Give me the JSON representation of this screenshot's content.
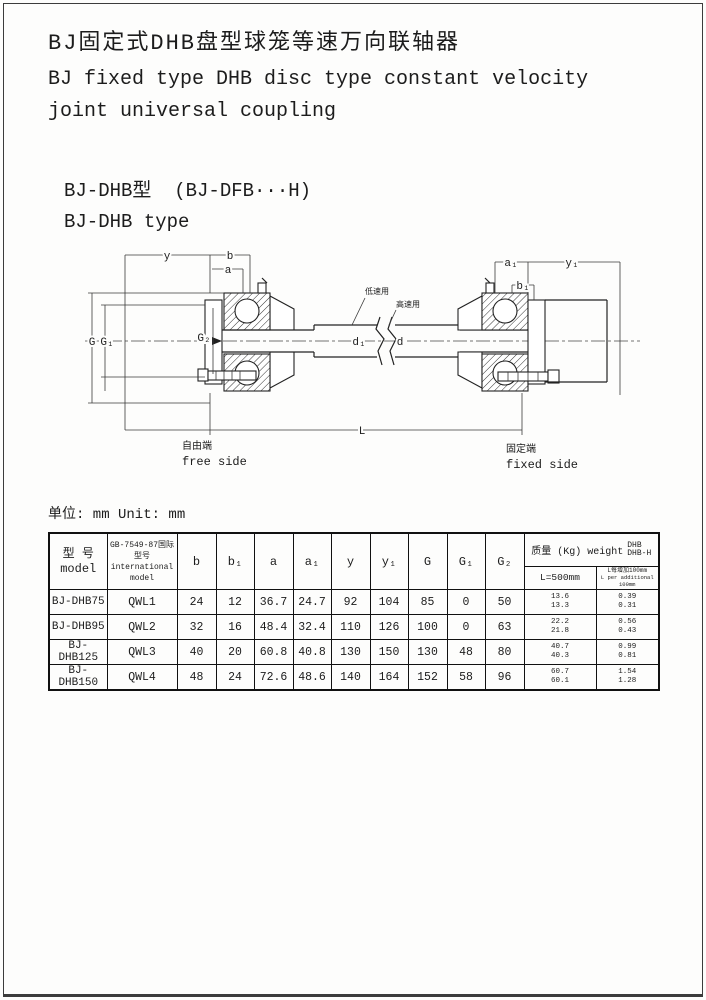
{
  "header": {
    "title_cn": "BJ固定式DHB盘型球笼等速万向联轴器",
    "title_en_line1": "BJ fixed type DHB disc type constant velocity",
    "title_en_line2": "joint universal coupling",
    "model_line_cn": "BJ-DHB型  (BJ-DFB···H)",
    "model_line_en": "BJ-DHB type"
  },
  "diagram": {
    "dim_labels": {
      "y": "y",
      "b": "b",
      "a": "a",
      "a1": "a₁",
      "b1": "b₁",
      "y1": "y₁",
      "G": "G",
      "G1": "G₁",
      "G2": "G₂",
      "d1": "d₁",
      "d": "d",
      "L": "L"
    },
    "callout_low_speed": "低速用",
    "callout_high_speed": "高速用",
    "free_side_cn": "自由端",
    "free_side_en": "free side",
    "fixed_side_cn": "固定端",
    "fixed_side_en": "fixed side"
  },
  "unit_note": "单位: mm Unit: mm",
  "table": {
    "header": {
      "model_cn": "型 号",
      "model_en": "model",
      "intl_cn": "GB-7549-87国际型号",
      "intl_en": "international model",
      "dims": [
        "b",
        "b₁",
        "a",
        "a₁",
        "y",
        "y₁",
        "G",
        "G₁",
        "G₂"
      ],
      "weight_title": "质量 (Kg) weight",
      "weight_type_top": "DHB",
      "weight_type_bottom": "DHB-H",
      "weight_col1": "L=500mm",
      "weight_col2_cn": "L每增加100mm",
      "weight_col2_en": "L per additional 100mm"
    },
    "rows": [
      {
        "model": "BJ-DHB75",
        "intl": "QWL1",
        "b": "24",
        "b1": "12",
        "a": "36.7",
        "a1": "24.7",
        "y": "92",
        "y1": "104",
        "G": "85",
        "G1": "0",
        "G2": "50",
        "w500_dhb": "13.6",
        "w500_dhbh": "13.3",
        "wadd_dhb": "0.39",
        "wadd_dhbh": "0.31"
      },
      {
        "model": "BJ-DHB95",
        "intl": "QWL2",
        "b": "32",
        "b1": "16",
        "a": "48.4",
        "a1": "32.4",
        "y": "110",
        "y1": "126",
        "G": "100",
        "G1": "0",
        "G2": "63",
        "w500_dhb": "22.2",
        "w500_dhbh": "21.8",
        "wadd_dhb": "0.56",
        "wadd_dhbh": "0.43"
      },
      {
        "model": "BJ-DHB125",
        "intl": "QWL3",
        "b": "40",
        "b1": "20",
        "a": "60.8",
        "a1": "40.8",
        "y": "130",
        "y1": "150",
        "G": "130",
        "G1": "48",
        "G2": "80",
        "w500_dhb": "40.7",
        "w500_dhbh": "40.3",
        "wadd_dhb": "0.99",
        "wadd_dhbh": "0.81"
      },
      {
        "model": "BJ-DHB150",
        "intl": "QWL4",
        "b": "48",
        "b1": "24",
        "a": "72.6",
        "a1": "48.6",
        "y": "140",
        "y1": "164",
        "G": "152",
        "G1": "58",
        "G2": "96",
        "w500_dhb": "60.7",
        "w500_dhbh": "60.1",
        "wadd_dhb": "1.54",
        "wadd_dhbh": "1.28"
      }
    ]
  }
}
